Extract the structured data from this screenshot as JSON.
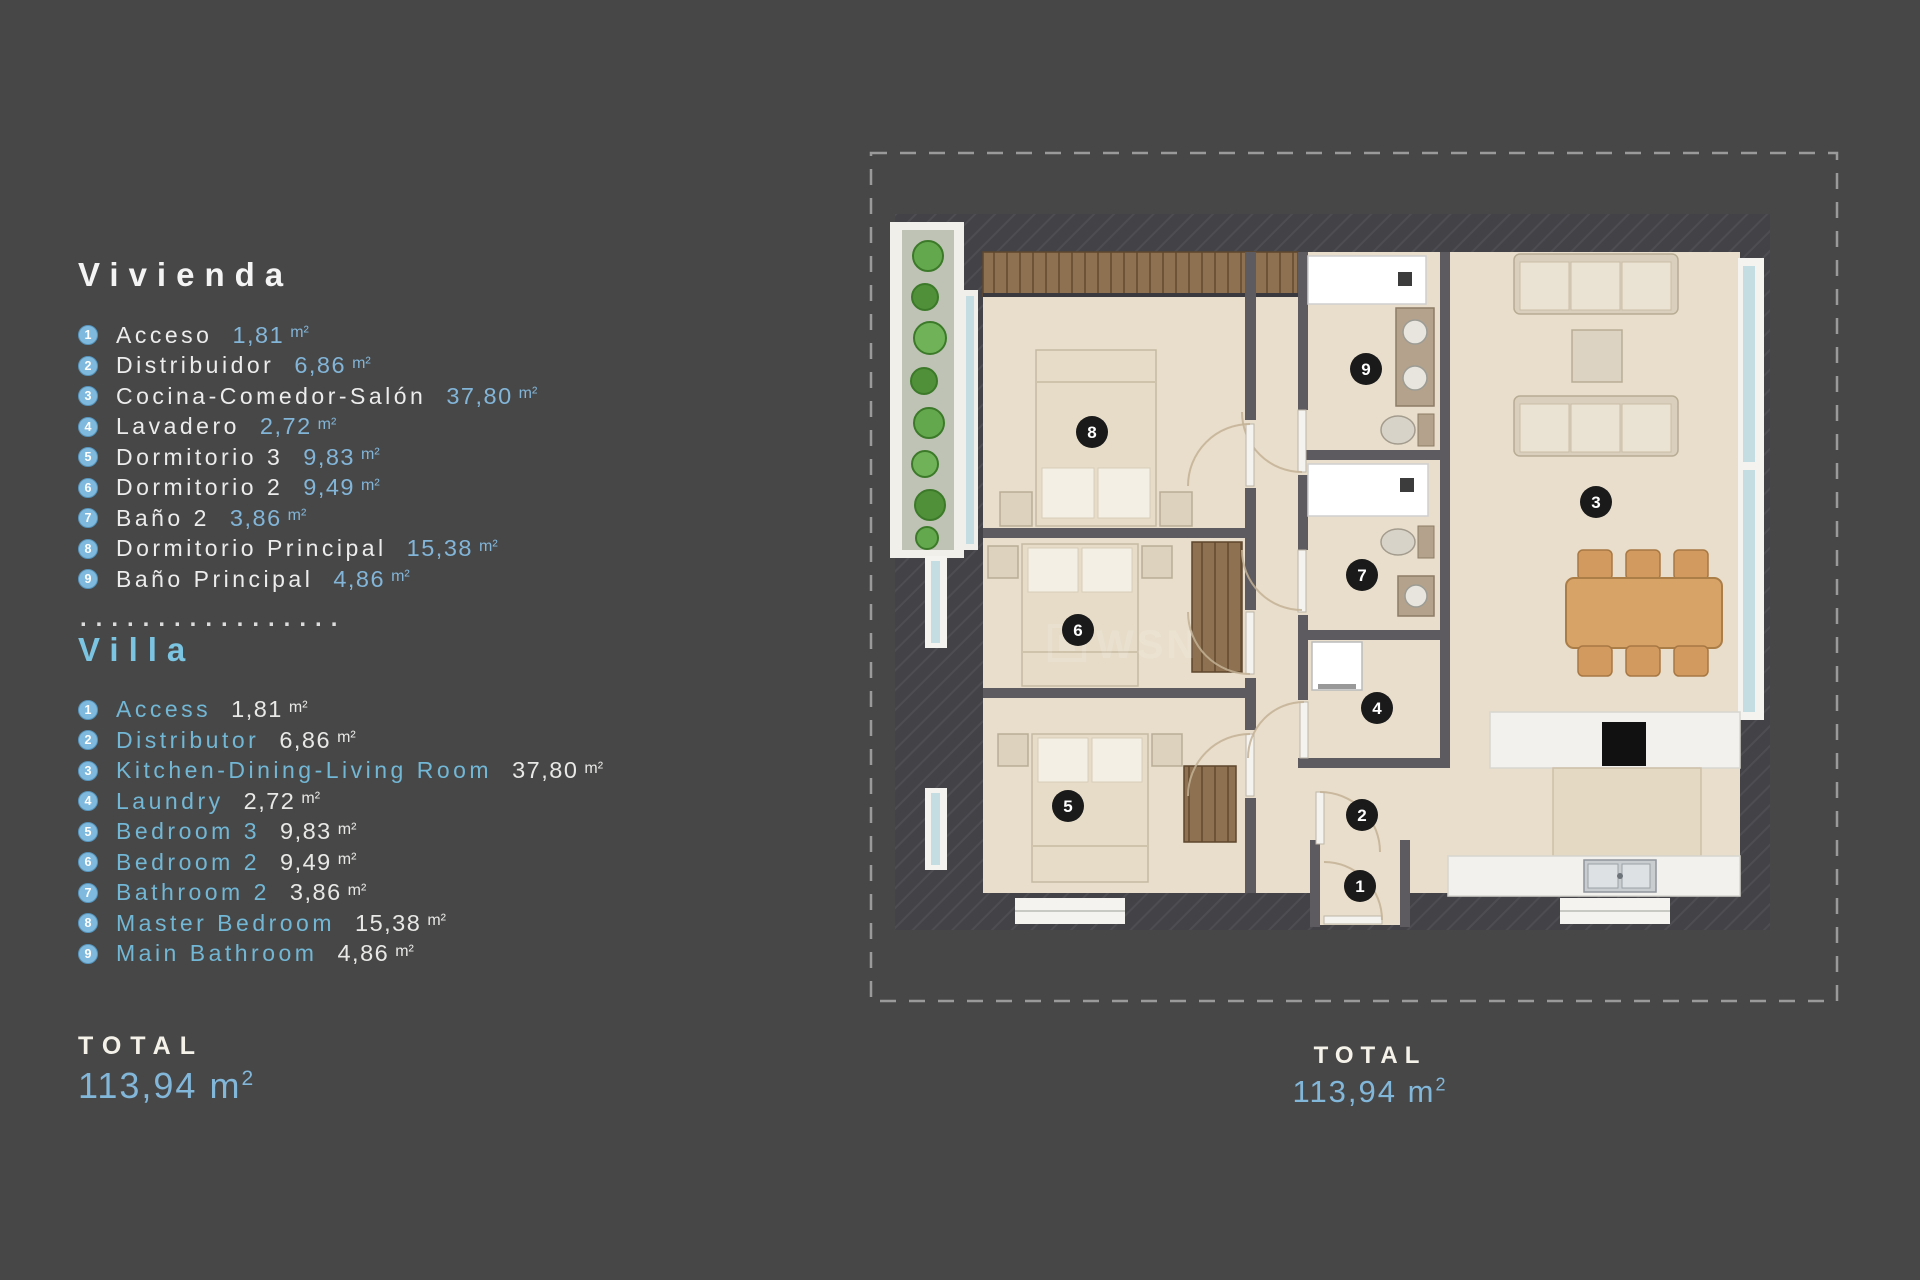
{
  "vivienda": {
    "title": "Vivienda",
    "items": [
      {
        "n": "1",
        "label": "Acceso",
        "area": "1,81",
        "unit": "m²"
      },
      {
        "n": "2",
        "label": "Distribuidor",
        "area": "6,86",
        "unit": "m²"
      },
      {
        "n": "3",
        "label": "Cocina-Comedor-Salón",
        "area": "37,80",
        "unit": "m²"
      },
      {
        "n": "4",
        "label": "Lavadero",
        "area": "2,72",
        "unit": "m²"
      },
      {
        "n": "5",
        "label": "Dormitorio 3",
        "area": "9,83",
        "unit": "m²"
      },
      {
        "n": "6",
        "label": "Dormitorio 2",
        "area": "9,49",
        "unit": "m²"
      },
      {
        "n": "7",
        "label": "Baño 2",
        "area": "3,86",
        "unit": "m²"
      },
      {
        "n": "8",
        "label": "Dormitorio Principal",
        "area": "15,38",
        "unit": "m²"
      },
      {
        "n": "9",
        "label": "Baño Principal",
        "area": "4,86",
        "unit": "m²"
      }
    ]
  },
  "separator": ".................",
  "villa": {
    "title": "Villa",
    "items": [
      {
        "n": "1",
        "label": "Access",
        "area": "1,81",
        "unit": "m²"
      },
      {
        "n": "2",
        "label": "Distributor",
        "area": "6,86",
        "unit": "m²"
      },
      {
        "n": "3",
        "label": "Kitchen-Dining-Living Room",
        "area": "37,80",
        "unit": "m²"
      },
      {
        "n": "4",
        "label": "Laundry",
        "area": "2,72",
        "unit": "m²"
      },
      {
        "n": "5",
        "label": "Bedroom 3",
        "area": "9,83",
        "unit": "m²"
      },
      {
        "n": "6",
        "label": "Bedroom 2",
        "area": "9,49",
        "unit": "m²"
      },
      {
        "n": "7",
        "label": "Bathroom 2",
        "area": "3,86",
        "unit": "m²"
      },
      {
        "n": "8",
        "label": "Master Bedroom",
        "area": "15,38",
        "unit": "m²"
      },
      {
        "n": "9",
        "label": "Main Bathroom",
        "area": "4,86",
        "unit": "m²"
      }
    ]
  },
  "total_left": {
    "label": "TOTAL",
    "value": "113,94",
    "unit": "m",
    "sup": "2"
  },
  "total_plan": {
    "label": "TOTAL",
    "value": "113,94",
    "unit": "m",
    "sup": "2"
  },
  "plan": {
    "watermark": "WSN",
    "markers": [
      "1",
      "2",
      "3",
      "4",
      "5",
      "6",
      "7",
      "8",
      "9"
    ]
  },
  "colors": {
    "accent_blue": "#82b5d8",
    "accent_teal": "#72b7d5",
    "text_light": "#ececec",
    "marker_dark": "#1a1a1a",
    "legend_badge": "#7fbade",
    "floor": "#e9decb",
    "wall": "#434347"
  }
}
